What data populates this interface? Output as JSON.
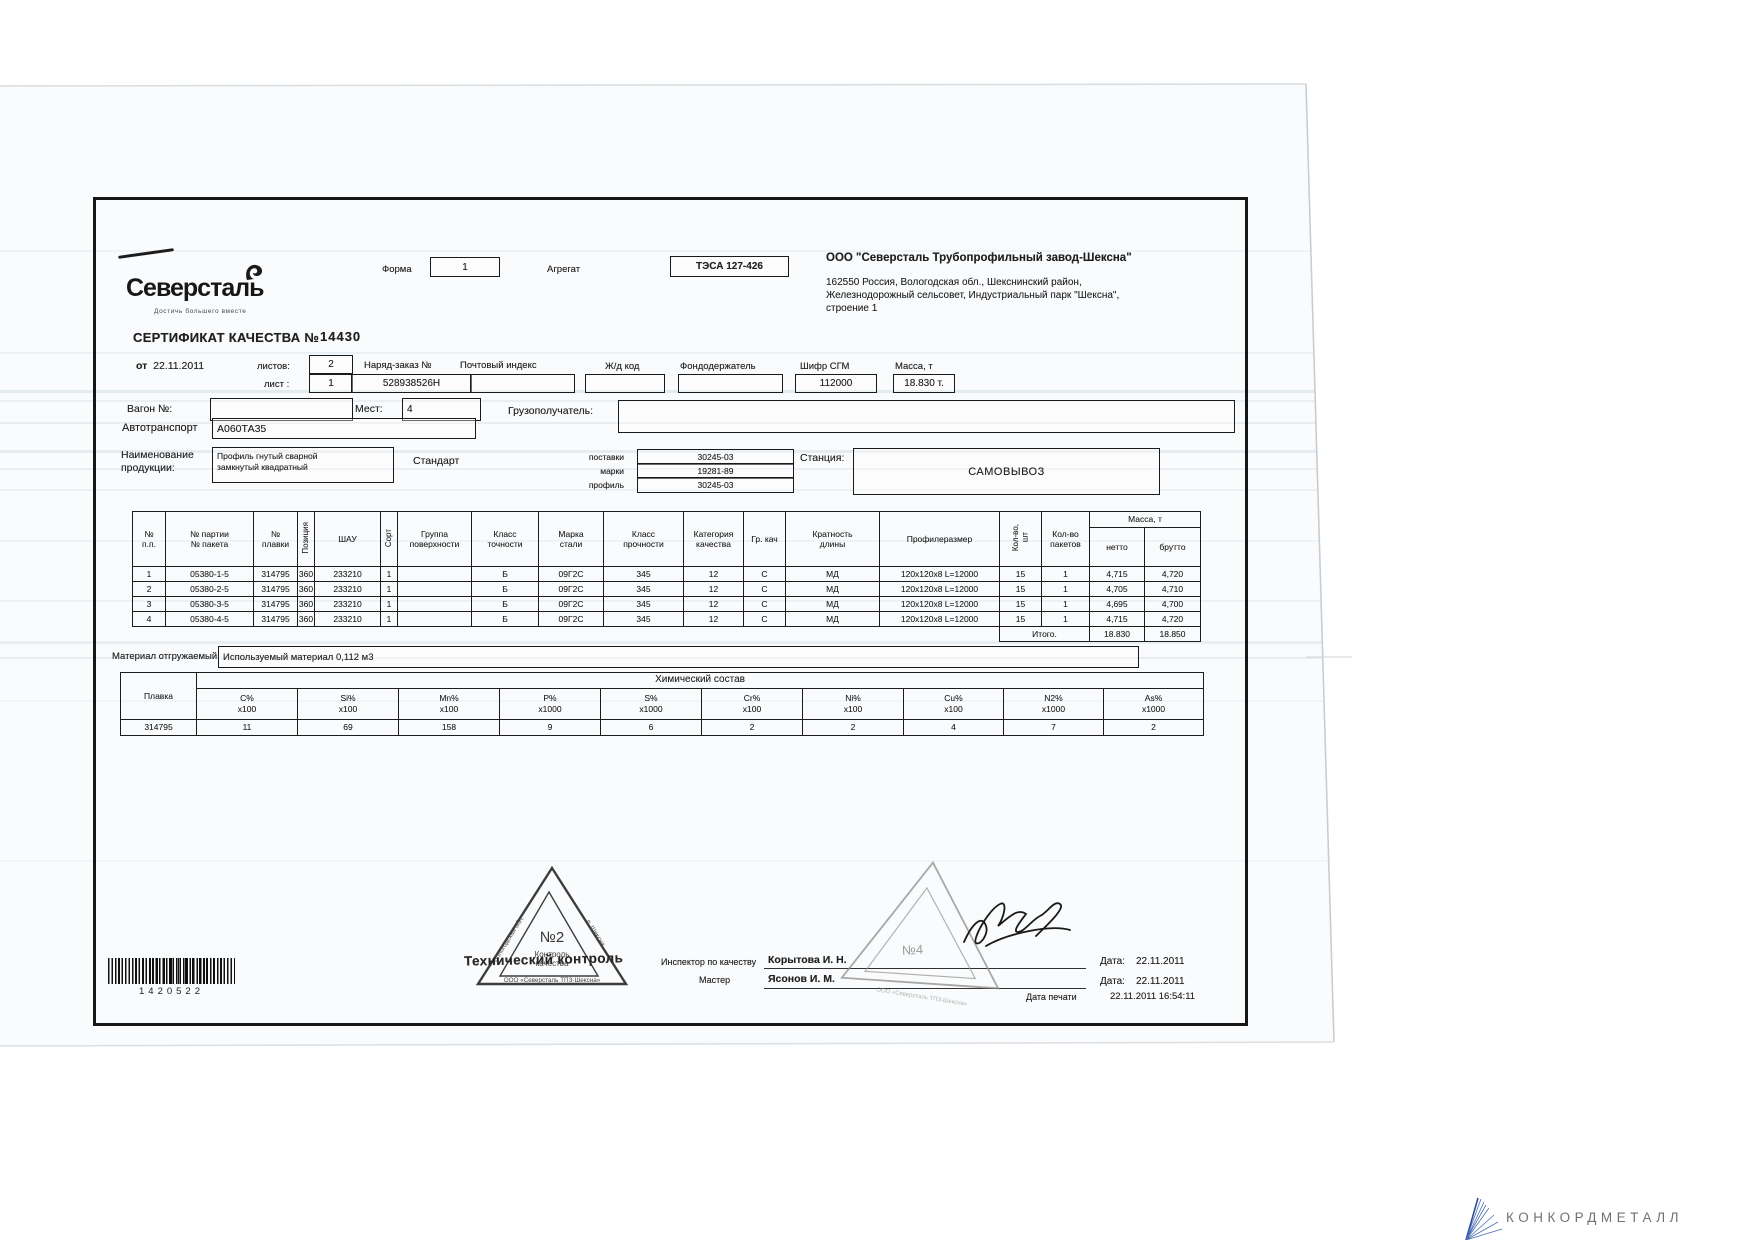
{
  "header": {
    "logo": "Северсталь",
    "logo_tagline": "Достичь большего вместе",
    "forma_label": "Форма",
    "forma_value": "1",
    "agregat_label": "Агрегат",
    "agregat_value": "ТЭСА 127-426",
    "company_name": "ООО \"Северсталь Трубопрофильный завод-Шексна\"",
    "address_lines": {
      "0": "162550 Россия, Вологодская обл., Шекснинский район,",
      "1": "Железнодорожный сельсовет, Индустриальный парк \"Шексна\",",
      "2": "строение 1"
    }
  },
  "cert": {
    "title": "СЕРТИФИКАТ КАЧЕСТВА №",
    "number": "14430",
    "date_label": "от",
    "date": "22.11.2011",
    "listov_label": "листов:",
    "listov_value": "2",
    "list_label": "лист :",
    "list_value": "1",
    "naryad_label": "Наряд-заказ №",
    "naryad_value": "528938526Н",
    "post_index_label": "Почтовый индекс",
    "zhd_label": "Ж/д код",
    "fond_label": "Фондодержатель",
    "shifr_label": "Шифр СГМ",
    "shifr_value": "112000",
    "massa_label": "Масса, т",
    "massa_value": "18.830 т.",
    "vagon_label": "Вагон №:",
    "mest_label": "Мест:",
    "mest_value": "4",
    "gruzo_label": "Грузополучатель:",
    "avto_label": "Автотранспорт",
    "avto_value": "А060ТА35",
    "naimen_label": "Наименование\nпродукции:",
    "product": "Профиль гнутый сварной\nзамкнутый квадратный",
    "standard_label": "Стандарт",
    "standard_rows": {
      "0": {
        "label": "поставки",
        "value": "30245-03"
      },
      "1": {
        "label": "марки",
        "value": "19281-89"
      },
      "2": {
        "label": "профиль",
        "value": "30245-03"
      }
    },
    "stancia_label": "Станция:",
    "stancia_value": "САМОВЫВОЗ"
  },
  "main_table": {
    "columns": {
      "0": "№\nп.п.",
      "1": "№ партии\n№ пакета",
      "2": "№\nплавки",
      "3": "Позиция",
      "4": "ШАУ",
      "5": "Сорт",
      "6": "Группа\nповерхности",
      "7": "Класс\nточности",
      "8": "Марка\nстали",
      "9": "Класс\nпрочности",
      "10": "Категория\nкачества",
      "11": "Гр. кач",
      "12": "Кратность\nдлины",
      "13": "Профилеразмер",
      "14": "Кол-во,\nшт",
      "15": "Кол-во\nпакетов"
    },
    "massa_group": "Масса, т",
    "netto": "нетто",
    "brutto": "брутто",
    "rows": [
      [
        "1",
        "05380-1-5",
        "314795",
        "360",
        "233210",
        "1",
        "",
        "Б",
        "09Г2С",
        "345",
        "12",
        "С",
        "МД",
        "120х120х8 L=12000",
        "15",
        "1",
        "4,715",
        "4,720"
      ],
      [
        "2",
        "05380-2-5",
        "314795",
        "360",
        "233210",
        "1",
        "",
        "Б",
        "09Г2С",
        "345",
        "12",
        "С",
        "МД",
        "120х120х8 L=12000",
        "15",
        "1",
        "4,705",
        "4,710"
      ],
      [
        "3",
        "05380-3-5",
        "314795",
        "360",
        "233210",
        "1",
        "",
        "Б",
        "09Г2С",
        "345",
        "12",
        "С",
        "МД",
        "120х120х8 L=12000",
        "15",
        "1",
        "4,695",
        "4,700"
      ],
      [
        "4",
        "05380-4-5",
        "314795",
        "360",
        "233210",
        "1",
        "",
        "Б",
        "09Г2С",
        "345",
        "12",
        "С",
        "МД",
        "120х120х8 L=12000",
        "15",
        "1",
        "4,715",
        "4,720"
      ]
    ],
    "itogo_label": "Итого.",
    "itogo_netto": "18.830",
    "itogo_brutto": "18.850"
  },
  "material": {
    "label": "Материал отгружаемый:",
    "value": "Используемый материал 0,112 м3"
  },
  "chem": {
    "plavka_label": "Плавка",
    "title": "Химический состав",
    "columns": [
      {
        "el": "C%",
        "mult": "х100"
      },
      {
        "el": "Si%",
        "mult": "х100"
      },
      {
        "el": "Mn%",
        "mult": "х100"
      },
      {
        "el": "P%",
        "mult": "х1000"
      },
      {
        "el": "S%",
        "mult": "х1000"
      },
      {
        "el": "Cr%",
        "mult": "х100"
      },
      {
        "el": "Ni%",
        "mult": "х100"
      },
      {
        "el": "Cu%",
        "mult": "х100"
      },
      {
        "el": "N2%",
        "mult": "х1000"
      },
      {
        "el": "As%",
        "mult": "х1000"
      }
    ],
    "plavka_value": "314795",
    "values": [
      "11",
      "69",
      "158",
      "9",
      "6",
      "2",
      "2",
      "4",
      "7",
      "2"
    ]
  },
  "footer": {
    "stamp1": {
      "number": "№2",
      "line1": "Контроль",
      "line2": "качества",
      "edge_left": "Вологодская обл.",
      "edge_right": "п. Шексна",
      "edge_bottom": "ООО «Северсталь ТПЗ-Шексна»"
    },
    "tech_control": "Технический контроль",
    "inspector_label": "Инспектор по качеству",
    "inspector_name": "Корытова И. Н.",
    "master_label": "Мастер",
    "master_name": "Ясонов И. М.",
    "stamp2": {
      "number": "№4",
      "edge_bottom": "ООО «Северсталь ТПЗ-Шексна»"
    },
    "date1_label": "Дата:",
    "date1_value": "22.11.2011",
    "date2_label": "Дата:",
    "date2_value": "22.11.2011",
    "print_label": "Дата печати",
    "print_value": "22.11.2011 16:54:11",
    "barcode_number": "1420522"
  },
  "watermark": {
    "brand": "КОНКОРДМЕТАЛЛ"
  }
}
